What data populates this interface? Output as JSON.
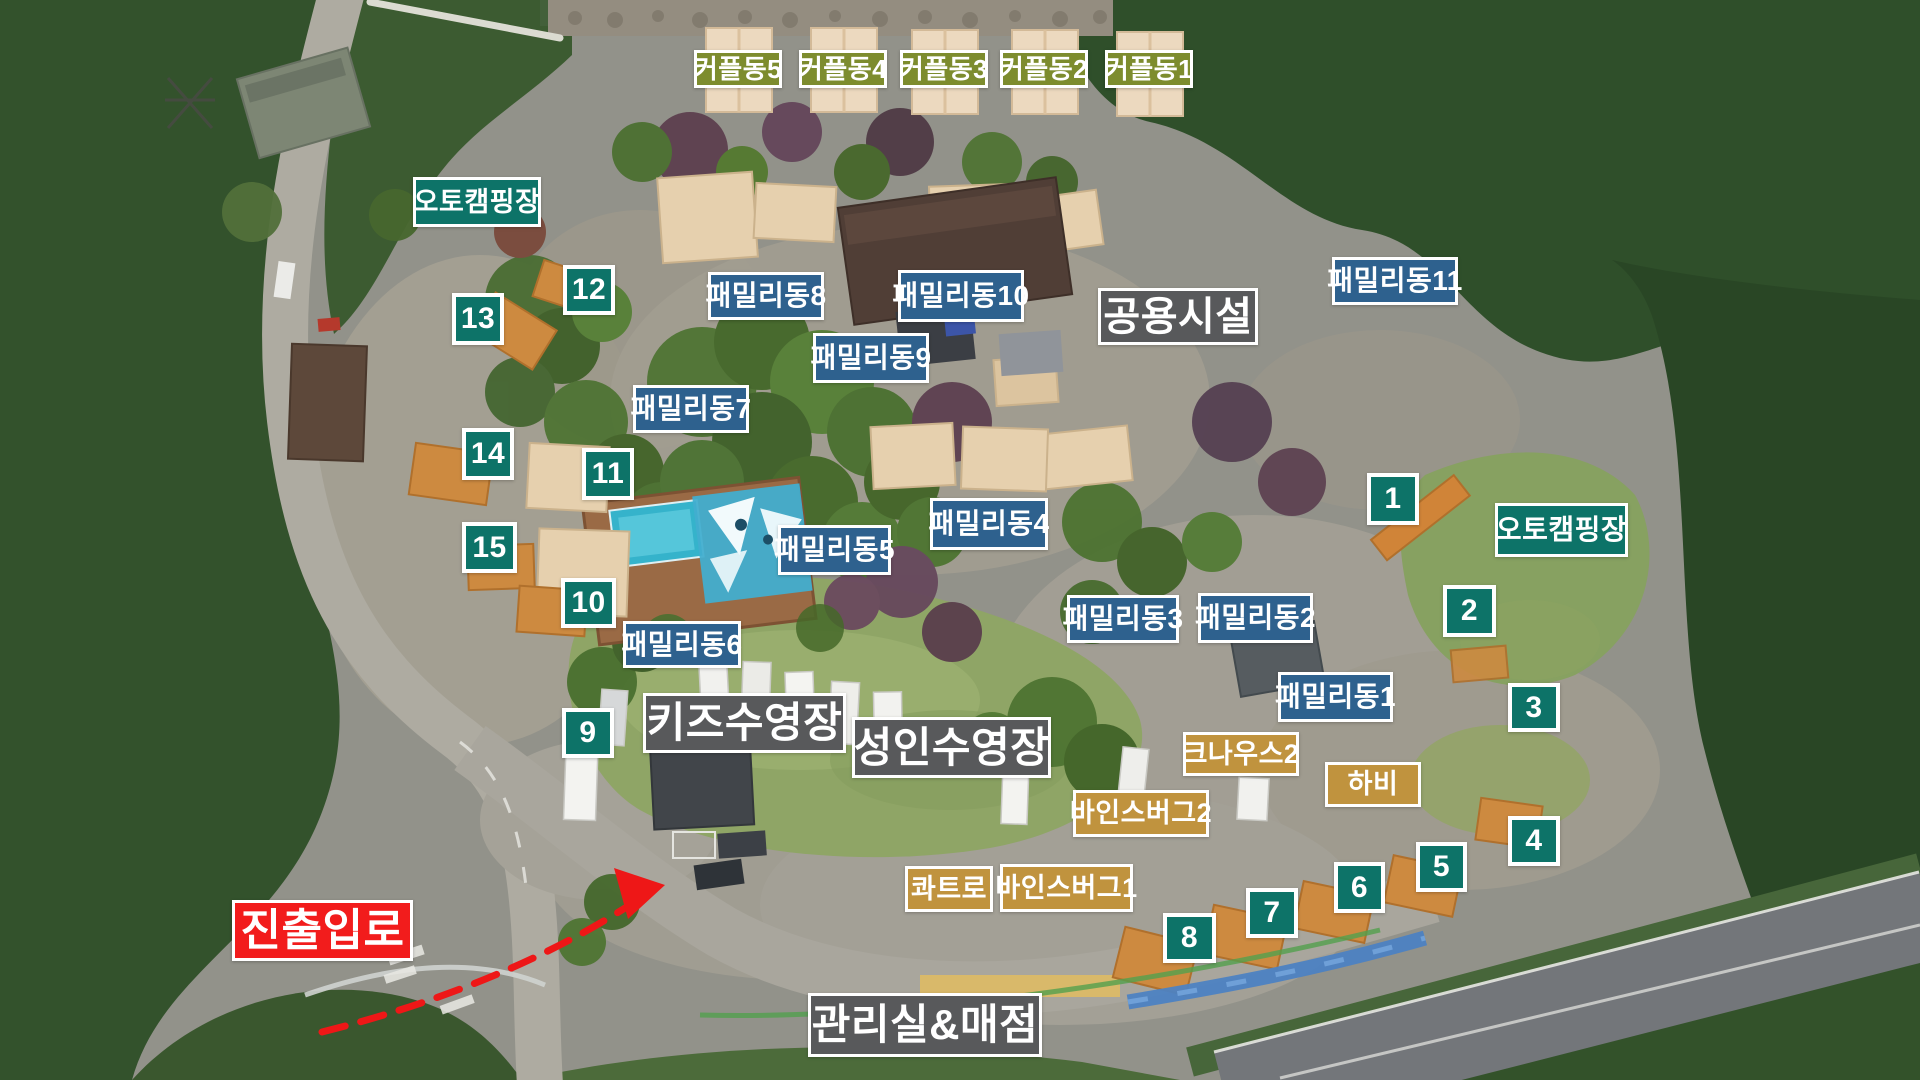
{
  "colors": {
    "site_teal": "#0d7368",
    "family_blue": "#2e618e",
    "facility_gray": "#58595b",
    "couple_olive": "#7d8c2e",
    "rv_tan": "#c0933e",
    "entrance_red": "#f21c1c",
    "label_border_white": "#ffffff"
  },
  "labels": [
    {
      "name": "label-coupledong-5",
      "text": "커플동5",
      "type": "couple",
      "x": 694,
      "y": 50,
      "w": 88,
      "h": 38
    },
    {
      "name": "label-coupledong-4",
      "text": "커플동4",
      "type": "couple",
      "x": 799,
      "y": 50,
      "w": 88,
      "h": 38
    },
    {
      "name": "label-coupledong-3",
      "text": "커플동3",
      "type": "couple",
      "x": 900,
      "y": 50,
      "w": 88,
      "h": 38
    },
    {
      "name": "label-coupledong-2",
      "text": "커플동2",
      "type": "couple",
      "x": 1000,
      "y": 50,
      "w": 88,
      "h": 38
    },
    {
      "name": "label-coupledong-1",
      "text": "커플동1",
      "type": "couple",
      "x": 1105,
      "y": 50,
      "w": 88,
      "h": 38
    },
    {
      "name": "label-auto-camping-left",
      "text": "오토캠핑장",
      "type": "zone",
      "x": 413,
      "y": 177,
      "w": 128,
      "h": 50,
      "fs": 27
    },
    {
      "name": "label-auto-camping-right",
      "text": "오토캠핑장",
      "type": "zone",
      "x": 1495,
      "y": 503,
      "w": 133,
      "h": 54
    },
    {
      "name": "label-site-12",
      "text": "12",
      "type": "site",
      "x": 563,
      "y": 265,
      "w": 52,
      "h": 50
    },
    {
      "name": "label-site-13",
      "text": "13",
      "type": "site",
      "x": 452,
      "y": 293,
      "w": 52,
      "h": 52
    },
    {
      "name": "label-site-14",
      "text": "14",
      "type": "site",
      "x": 462,
      "y": 428,
      "w": 52,
      "h": 52
    },
    {
      "name": "label-site-15",
      "text": "15",
      "type": "site",
      "x": 462,
      "y": 522,
      "w": 55,
      "h": 51
    },
    {
      "name": "label-site-11",
      "text": "11",
      "type": "site",
      "x": 582,
      "y": 448,
      "w": 52,
      "h": 52
    },
    {
      "name": "label-site-10",
      "text": "10",
      "type": "site",
      "x": 561,
      "y": 578,
      "w": 55,
      "h": 50
    },
    {
      "name": "label-site-9",
      "text": "9",
      "type": "site",
      "x": 562,
      "y": 708,
      "w": 52,
      "h": 50
    },
    {
      "name": "label-site-1",
      "text": "1",
      "type": "site",
      "x": 1367,
      "y": 473,
      "w": 52,
      "h": 52
    },
    {
      "name": "label-site-2",
      "text": "2",
      "type": "site",
      "x": 1443,
      "y": 585,
      "w": 53,
      "h": 52
    },
    {
      "name": "label-site-3",
      "text": "3",
      "type": "site",
      "x": 1508,
      "y": 683,
      "w": 52,
      "h": 49
    },
    {
      "name": "label-site-4",
      "text": "4",
      "type": "site",
      "x": 1508,
      "y": 816,
      "w": 52,
      "h": 50
    },
    {
      "name": "label-site-5",
      "text": "5",
      "type": "site",
      "x": 1416,
      "y": 842,
      "w": 51,
      "h": 50
    },
    {
      "name": "label-site-6",
      "text": "6",
      "type": "site",
      "x": 1334,
      "y": 862,
      "w": 51,
      "h": 51
    },
    {
      "name": "label-site-7",
      "text": "7",
      "type": "site",
      "x": 1246,
      "y": 888,
      "w": 52,
      "h": 50
    },
    {
      "name": "label-site-8",
      "text": "8",
      "type": "site",
      "x": 1163,
      "y": 913,
      "w": 53,
      "h": 50
    },
    {
      "name": "label-familydong-8",
      "text": "패밀리동8",
      "type": "family",
      "x": 708,
      "y": 272,
      "w": 116,
      "h": 48
    },
    {
      "name": "label-familydong-10",
      "text": "패밀리동10",
      "type": "family",
      "x": 898,
      "y": 270,
      "w": 126,
      "h": 52
    },
    {
      "name": "label-familydong-9",
      "text": "패밀리동9",
      "type": "family",
      "x": 813,
      "y": 333,
      "w": 116,
      "h": 50
    },
    {
      "name": "label-familydong-7",
      "text": "패밀리동7",
      "type": "family",
      "x": 633,
      "y": 385,
      "w": 116,
      "h": 48
    },
    {
      "name": "label-familydong-11",
      "text": "패밀리동11",
      "type": "family",
      "x": 1332,
      "y": 257,
      "w": 126,
      "h": 48
    },
    {
      "name": "label-familydong-4",
      "text": "패밀리동4",
      "type": "family",
      "x": 930,
      "y": 498,
      "w": 118,
      "h": 52
    },
    {
      "name": "label-familydong-5",
      "text": "패밀리동5",
      "type": "family",
      "x": 778,
      "y": 525,
      "w": 113,
      "h": 50
    },
    {
      "name": "label-familydong-6",
      "text": "패밀리동6",
      "type": "family",
      "x": 623,
      "y": 621,
      "w": 118,
      "h": 47
    },
    {
      "name": "label-familydong-3",
      "text": "패밀리동3",
      "type": "family",
      "x": 1067,
      "y": 595,
      "w": 112,
      "h": 48
    },
    {
      "name": "label-familydong-2",
      "text": "패밀리동2",
      "type": "family",
      "x": 1198,
      "y": 593,
      "w": 115,
      "h": 50
    },
    {
      "name": "label-familydong-1",
      "text": "패밀리동1",
      "type": "family",
      "x": 1278,
      "y": 672,
      "w": 115,
      "h": 50
    },
    {
      "name": "label-shared-facility",
      "text": "공용시설",
      "type": "facility",
      "x": 1098,
      "y": 288,
      "w": 160,
      "h": 57
    },
    {
      "name": "label-kids-pool",
      "text": "키즈수영장",
      "type": "facility",
      "x": 643,
      "y": 693,
      "w": 203,
      "h": 60,
      "fs": 42
    },
    {
      "name": "label-adult-pool",
      "text": "성인수영장",
      "type": "facility",
      "x": 852,
      "y": 717,
      "w": 199,
      "h": 61,
      "fs": 42
    },
    {
      "name": "label-office-store",
      "text": "관리실&매점",
      "type": "facility",
      "x": 808,
      "y": 993,
      "w": 234,
      "h": 64,
      "fs": 42
    },
    {
      "name": "label-knaus-2",
      "text": "크나우스2",
      "type": "rv",
      "x": 1183,
      "y": 732,
      "w": 116,
      "h": 44
    },
    {
      "name": "label-hobby",
      "text": "하비",
      "type": "rv",
      "x": 1325,
      "y": 762,
      "w": 96,
      "h": 45
    },
    {
      "name": "label-weinsberg-2",
      "text": "바인스버그2",
      "type": "rv",
      "x": 1073,
      "y": 790,
      "w": 136,
      "h": 47
    },
    {
      "name": "label-quatro",
      "text": "콰트로",
      "type": "rv",
      "x": 905,
      "y": 866,
      "w": 88,
      "h": 46
    },
    {
      "name": "label-weinsberg-1",
      "text": "바인스버그1",
      "type": "rv",
      "x": 1000,
      "y": 864,
      "w": 133,
      "h": 48
    },
    {
      "name": "label-entrance-exit",
      "text": "진출입로",
      "type": "entrance",
      "x": 232,
      "y": 900,
      "w": 181,
      "h": 61
    }
  ],
  "arrow": {
    "path": "M322,1032 C430,1005 545,962 642,897",
    "head": "665,885 614,868 628,919",
    "color": "#ee1717"
  }
}
